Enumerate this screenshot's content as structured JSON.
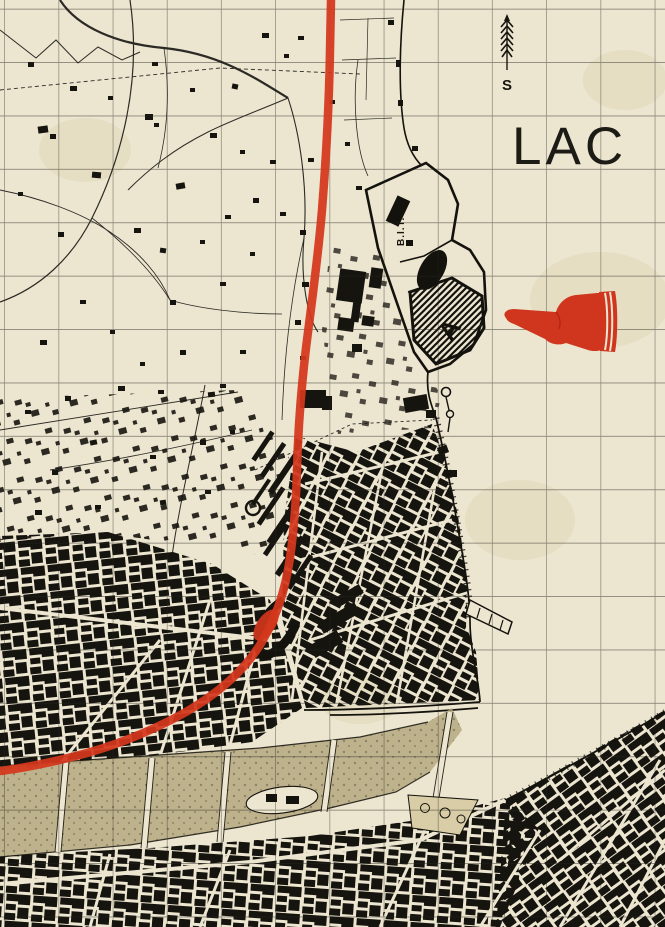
{
  "map": {
    "labels": {
      "lake": "LAC",
      "north": "S",
      "bit_site": "B.I.T.",
      "site_a": "A",
      "site_b": "B"
    },
    "symbols": {
      "manicule": "red-pointing-hand-left",
      "north_arrow": "feathered-arrow-up"
    },
    "colors": {
      "paper": "#ece5cf",
      "ink": "#1b1914",
      "route_red": "#d4371c",
      "river_wash": "#b1a47a",
      "park_wash": "#d8cda6",
      "grid": "#26241e"
    }
  }
}
